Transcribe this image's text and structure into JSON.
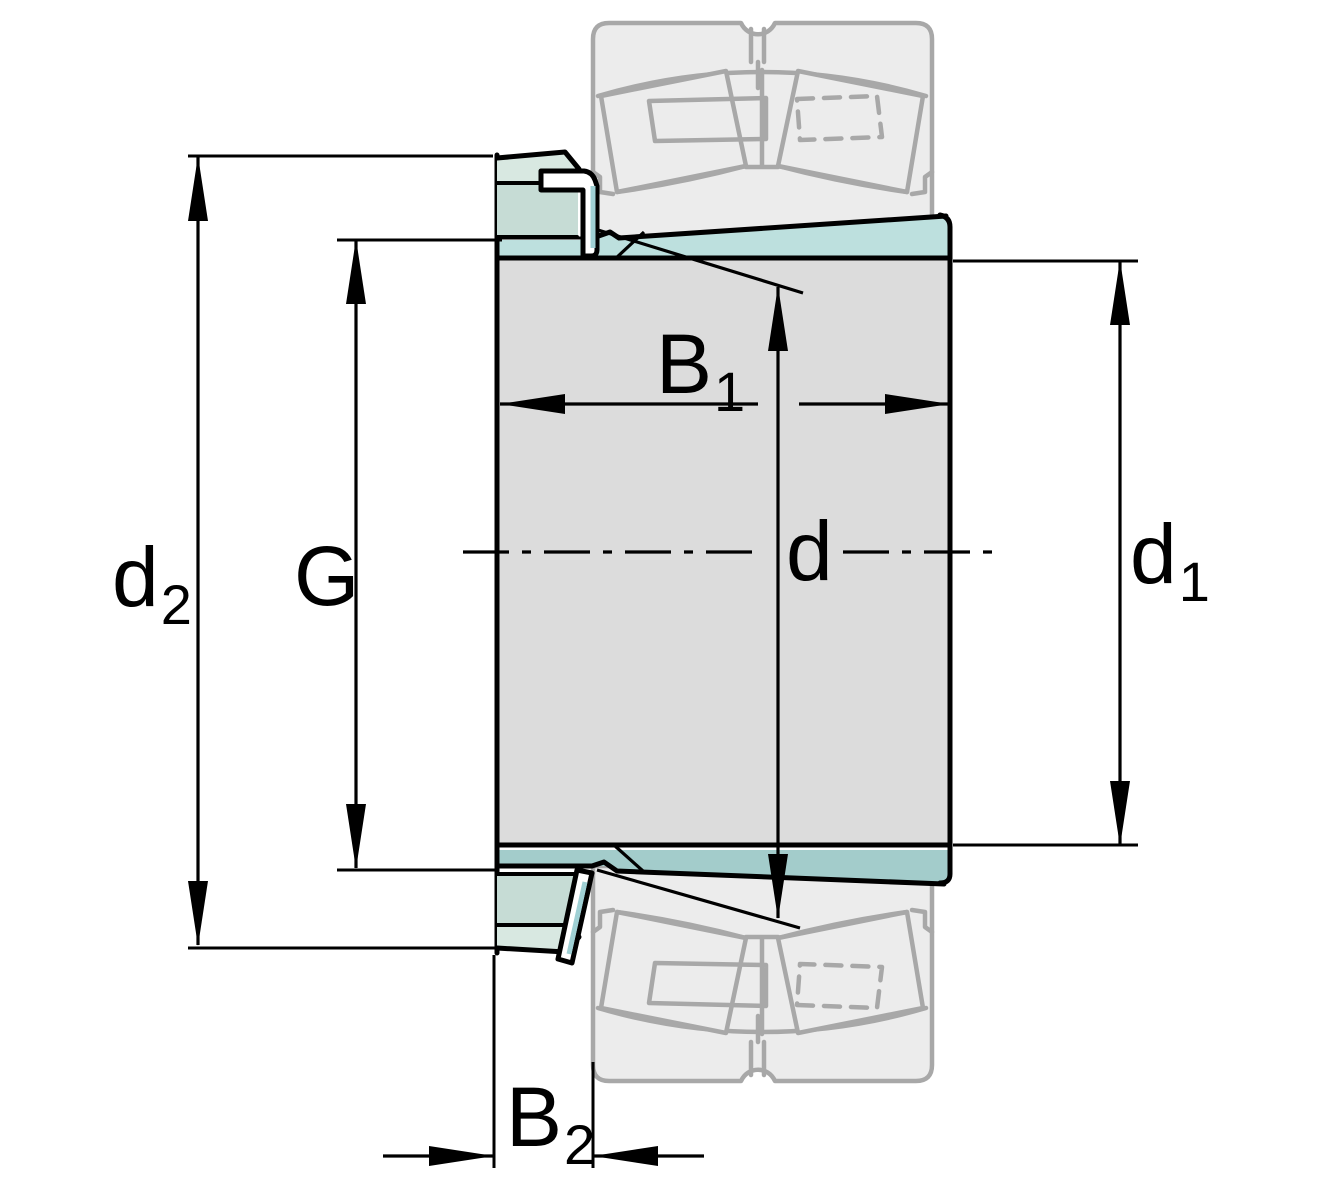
{
  "title": "Adapter sleeve with mounted spherical roller bearing — dimension drawing",
  "labels": {
    "d2": {
      "main": "d",
      "sub": "2"
    },
    "G": {
      "main": "G",
      "sub": ""
    },
    "B1": {
      "main": "B",
      "sub": "1"
    },
    "d": {
      "main": "d",
      "sub": ""
    },
    "d1": {
      "main": "d",
      "sub": "1"
    },
    "B2": {
      "main": "B",
      "sub": "2"
    }
  },
  "colors": {
    "sleeve_teal_top": "#bde0de",
    "sleeve_teal_bottom": "#a3cccb",
    "nut_body_green": "#c6dcd5",
    "nut_chamfer_green": "#d8e8e1",
    "washer_white": "#ffffff",
    "shaft_grey": "#dcdcdc",
    "ghost_fill": "#ececec",
    "ghost_stroke": "#a8a8a8",
    "line_black": "#000000"
  }
}
